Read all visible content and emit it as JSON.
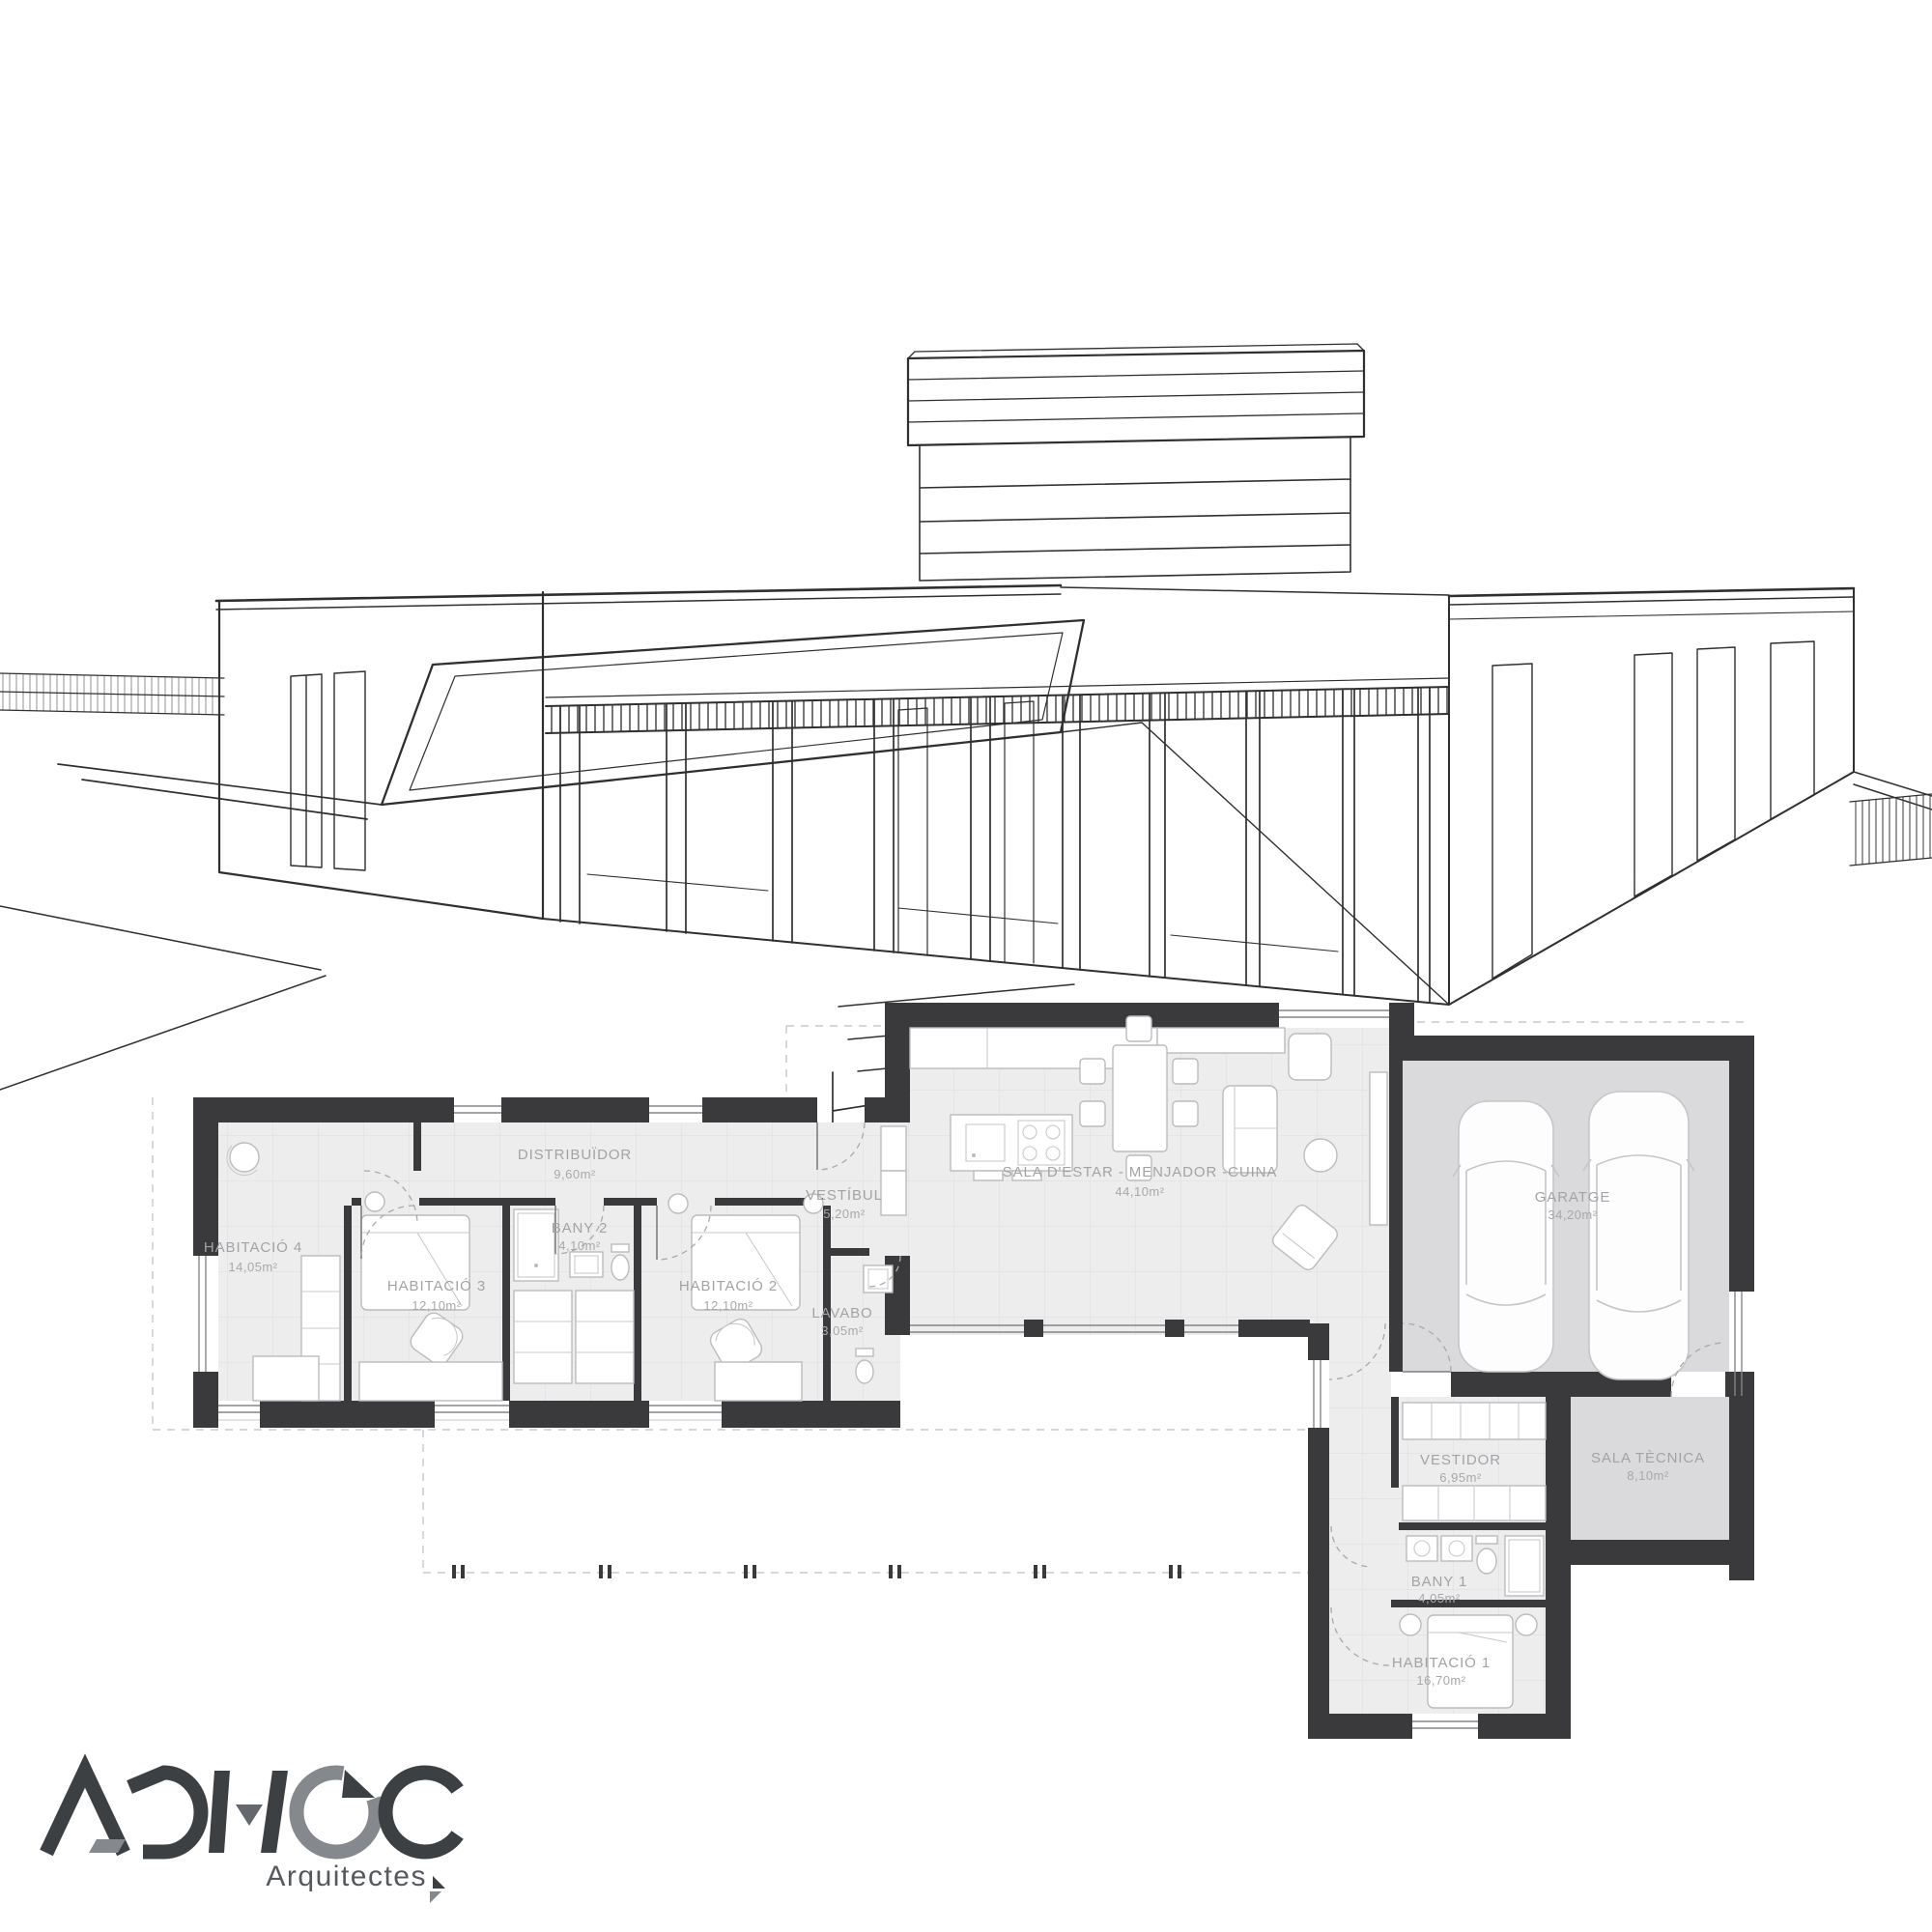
{
  "plan": {
    "rooms": [
      {
        "name": "DISTRIBUÏDOR",
        "area": "9,60m²"
      },
      {
        "name": "HABITACIÓ 4",
        "area": "14,05m²"
      },
      {
        "name": "HABITACIÓ 3",
        "area": "12,10m²"
      },
      {
        "name": "BANY 2",
        "area": "4,10m²"
      },
      {
        "name": "HABITACIÓ 2",
        "area": "12,10m²"
      },
      {
        "name": "VESTÍBUL",
        "area": "5,20m²"
      },
      {
        "name": "LAVABO",
        "area": "3,05m²"
      },
      {
        "name": "SALA D'ESTAR - MENJADOR -CUINA",
        "area": "44,10m²"
      },
      {
        "name": "GARATGE",
        "area": "34,20m²"
      },
      {
        "name": "VESTIDOR",
        "area": "6,95m²"
      },
      {
        "name": "SALA TÈCNICA",
        "area": "8,10m²"
      },
      {
        "name": "BANY 1",
        "area": "4,05m²"
      },
      {
        "name": "HABITACIÓ 1",
        "area": "16,70m²"
      }
    ],
    "colors": {
      "wall": "#3a3a3c",
      "floor": "#ededee",
      "garage_floor": "#dadadc",
      "label": "#a3a3a6",
      "sketch_line": "#2f2f2f"
    }
  },
  "logo": {
    "title": "AD HOC",
    "subtitle": "Arquitectes",
    "dark": "#3d4043",
    "gray": "#85888c"
  }
}
